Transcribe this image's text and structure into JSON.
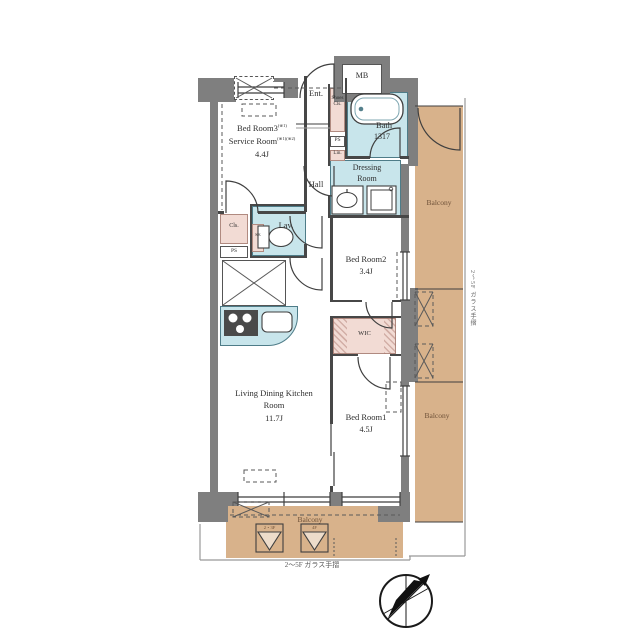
{
  "plan": {
    "mb": "MB",
    "ent": "Ent.",
    "shoes_l1": "Shoes",
    "shoes_l2": "Cls.",
    "ps_top": "PS",
    "lin": "Lin.",
    "bath": "Bath",
    "bath_size": "1317",
    "dressing_l1": "Dressing",
    "dressing_l2": "Room",
    "hall": "Hall",
    "bedroom3": "Bed Room3",
    "bedroom3_note": "(※1)",
    "service_room": "Service Room",
    "service_room_note": "(※1)(※2)",
    "bedroom3_size": "4.4J",
    "cls": "Cls.",
    "ps_mid": "PS",
    "sk": "SK",
    "lav": "Lav.",
    "bedroom2": "Bed Room2",
    "bedroom2_size": "3.4J",
    "wic": "WIC",
    "ldk_l1": "Living Dining Kitchen",
    "ldk_l2": "Room",
    "ldk_size": "11.7J",
    "bedroom1": "Bed Room1",
    "bedroom1_size": "4.5J",
    "balcony_right_upper": "Balcony",
    "balcony_right_lower": "Balcony",
    "balcony_bottom": "Balcony",
    "rail_caption_right": "2〜5F ガラス手摺",
    "rail_caption_bottom": "2〜5F ガラス手摺",
    "hatch_floor_left": "2・3F",
    "hatch_floor_right": "4F"
  },
  "colors": {
    "wall": "#7f7f7f",
    "water": "#c8e5eb",
    "closet": "#f2dbd4",
    "balcony": "#d8b28b",
    "line": "#3f3f3f"
  }
}
